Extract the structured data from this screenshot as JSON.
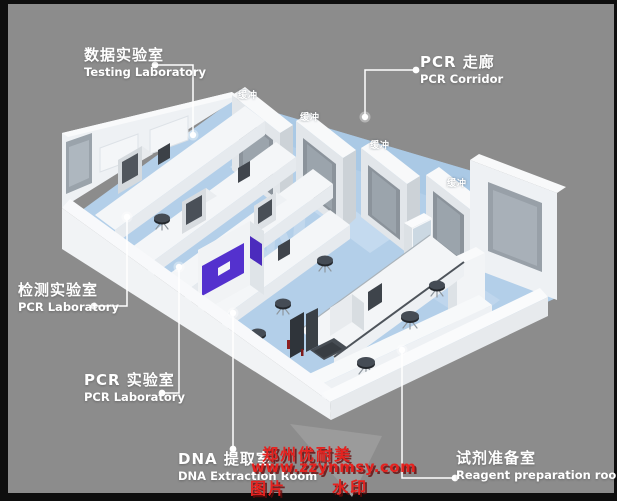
{
  "frame": {
    "border_color": "#0e0e0e",
    "background_color": "#8c8c8c"
  },
  "callouts": {
    "testing_lab": {
      "zh": "数据实验室",
      "en": "Testing Laboratory"
    },
    "pcr_corridor": {
      "zh": "PCR 走廊",
      "en": "PCR Corridor"
    },
    "detection_lab": {
      "zh": "检测实验室",
      "en": "PCR Laboratory"
    },
    "pcr_lab": {
      "zh": "PCR 实验室",
      "en": "PCR Laboratory"
    },
    "dna_extraction": {
      "zh": "DNA 提取室",
      "en": "DNA Extraction Room"
    },
    "reagent_prep": {
      "zh": "试剂准备室",
      "en": "Reagent preparation room"
    }
  },
  "floorplan": {
    "buffer_rooms": [
      {
        "label": "缓冲"
      },
      {
        "label": "缓冲"
      },
      {
        "label": "缓冲"
      },
      {
        "label": "缓冲"
      }
    ],
    "floor_mark": "W"
  },
  "watermark": {
    "brand": "郑州优耐美",
    "website": "www.zzynmsy.com",
    "tag_left": "图片",
    "tag_right": "水印",
    "color": "#e6221f"
  },
  "palette": {
    "floor_blue": "#b3cfe9",
    "corridor_blue": "#a4c4e3",
    "wall_white": "#f2f3f5",
    "window_gray": "#98a0a8",
    "accent_purple": "#5431ce",
    "callout_white": "#ffffff"
  }
}
